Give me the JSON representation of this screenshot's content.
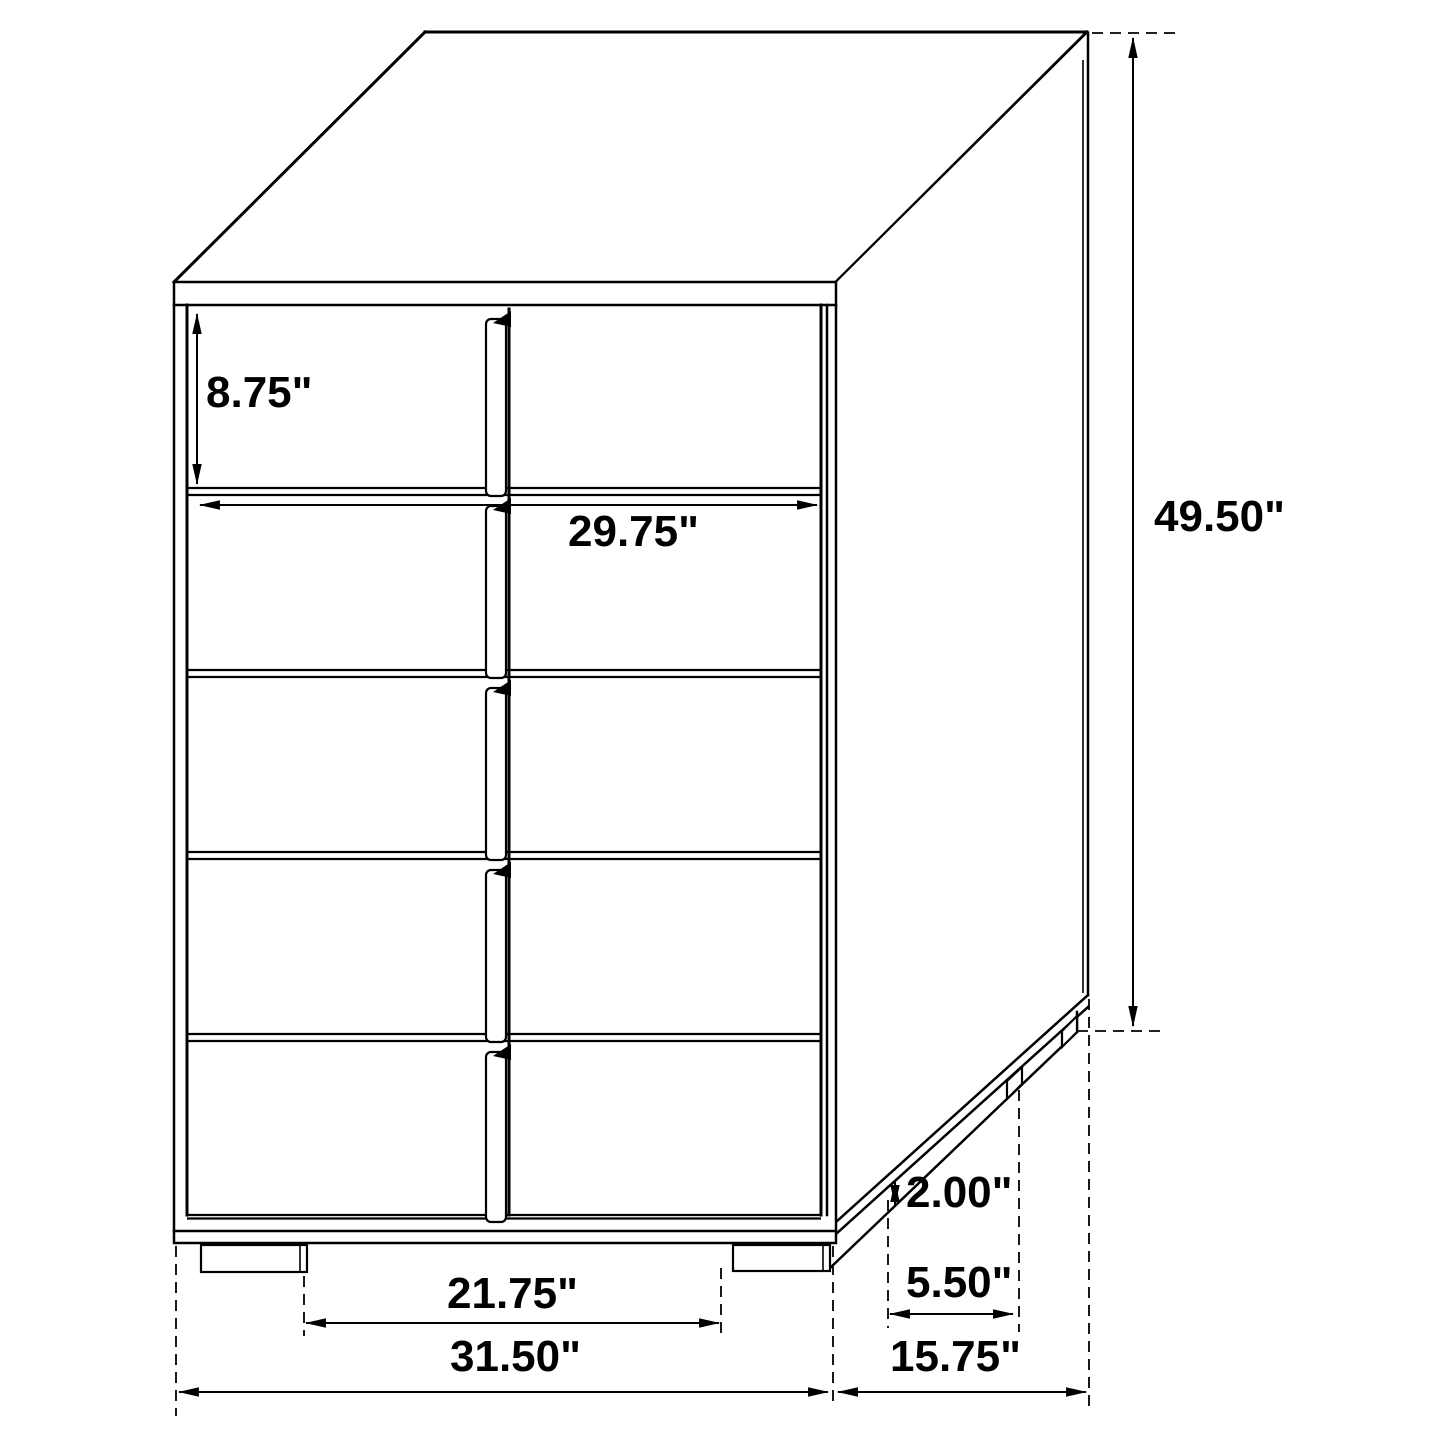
{
  "diagram": {
    "type": "furniture-dimension-drawing",
    "subject": "five-drawer-chest",
    "unit": "inches",
    "background_color": "#ffffff",
    "line_color": "#000000",
    "drawer_count": 5,
    "drawer_columns": 2,
    "dimensions": {
      "drawer_height": {
        "label": "8.75\"",
        "value": 8.75
      },
      "drawer_front_width": {
        "label": "29.75\"",
        "value": 29.75
      },
      "overall_height": {
        "label": "49.50\"",
        "value": 49.5
      },
      "base_height": {
        "label": "2.00\"",
        "value": 2.0
      },
      "side_leg_spacing": {
        "label": "5.50\"",
        "value": 5.5
      },
      "front_leg_spacing": {
        "label": "21.75\"",
        "value": 21.75
      },
      "overall_width": {
        "label": "31.50\"",
        "value": 31.5
      },
      "overall_depth": {
        "label": "15.75\"",
        "value": 15.75
      }
    }
  }
}
